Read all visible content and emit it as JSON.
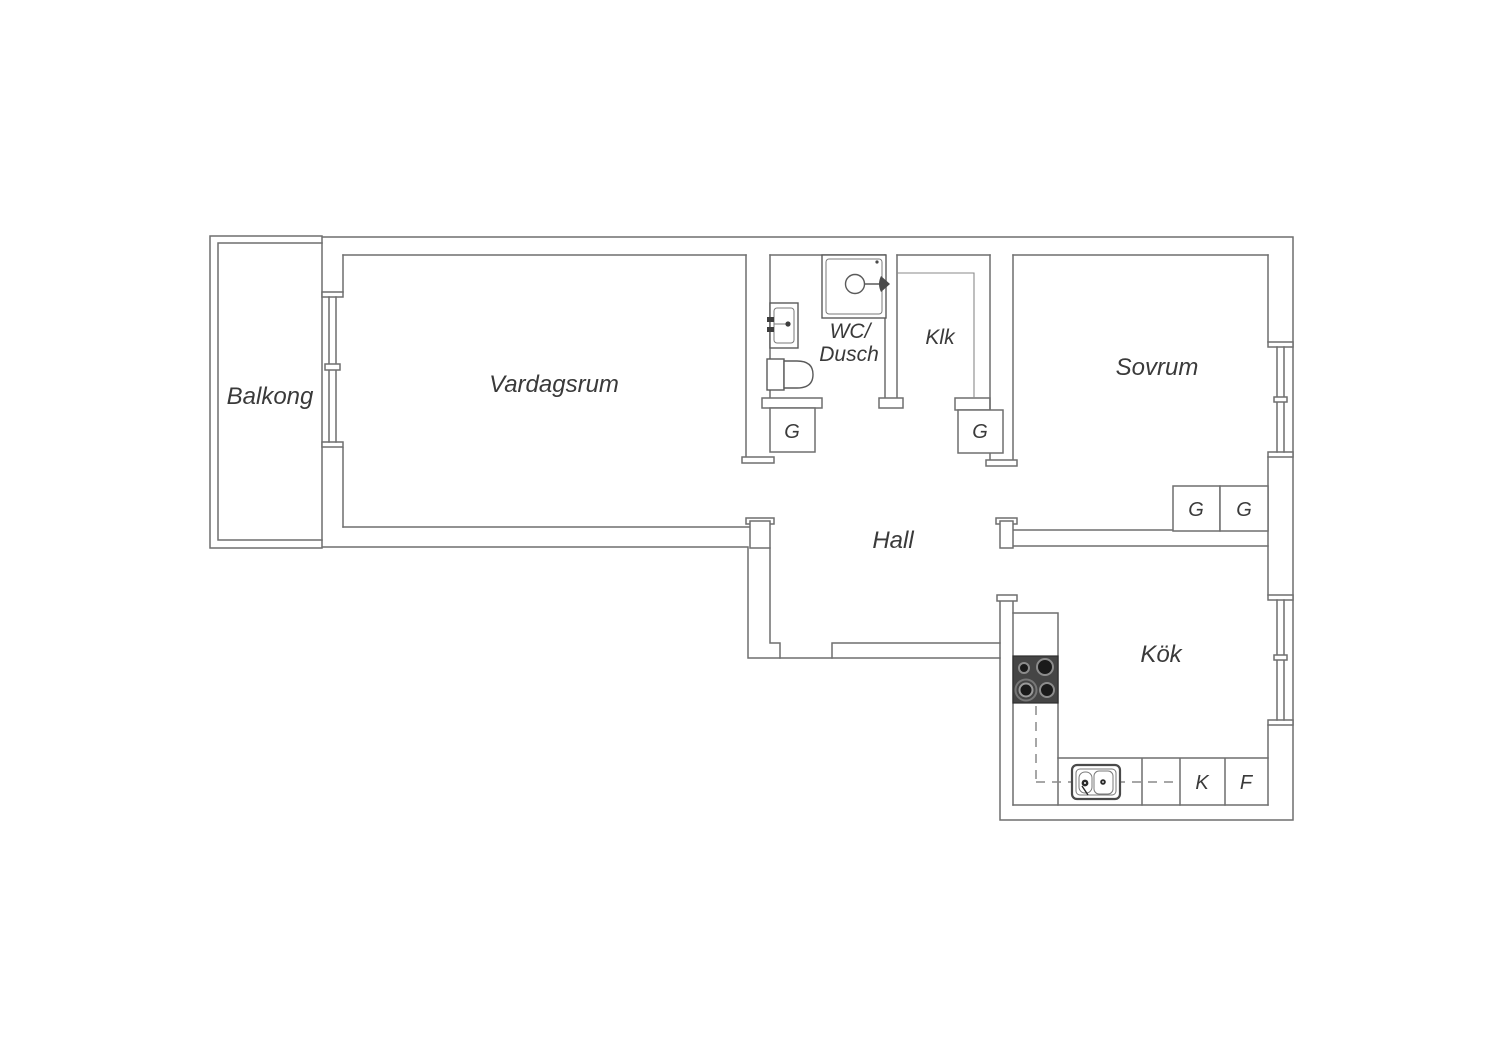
{
  "document": {
    "type": "apartment floor plan",
    "background_color": "#ffffff",
    "wall_line_color": "#6f6f6f",
    "text_color": "#3a3a3a",
    "stove_color": "#454545"
  },
  "rooms": {
    "balkong": {
      "label": "Balkong"
    },
    "vardagsrum": {
      "label": "Vardagsrum"
    },
    "wc_dusch": {
      "label_line1": "WC/",
      "label_line2": "Dusch"
    },
    "klk": {
      "label": "Klk"
    },
    "sovrum": {
      "label": "Sovrum"
    },
    "hall": {
      "label": "Hall"
    },
    "kok": {
      "label": "Kök"
    }
  },
  "storage": {
    "wc_wardrobe": {
      "label": "G"
    },
    "klk_wardrobe": {
      "label": "G"
    },
    "sovrum_wardrobe_1": {
      "label": "G"
    },
    "sovrum_wardrobe_2": {
      "label": "G"
    }
  },
  "kitchen_units": {
    "fridge": {
      "label": "K"
    },
    "freezer": {
      "label": "F"
    }
  },
  "fixtures": [
    "shower-cabin",
    "washbasin",
    "toilet",
    "stove-4-burners",
    "kitchen-sink",
    "balcony-window-door",
    "bedroom-window",
    "kitchen-window",
    "worktop-dashed-line"
  ]
}
